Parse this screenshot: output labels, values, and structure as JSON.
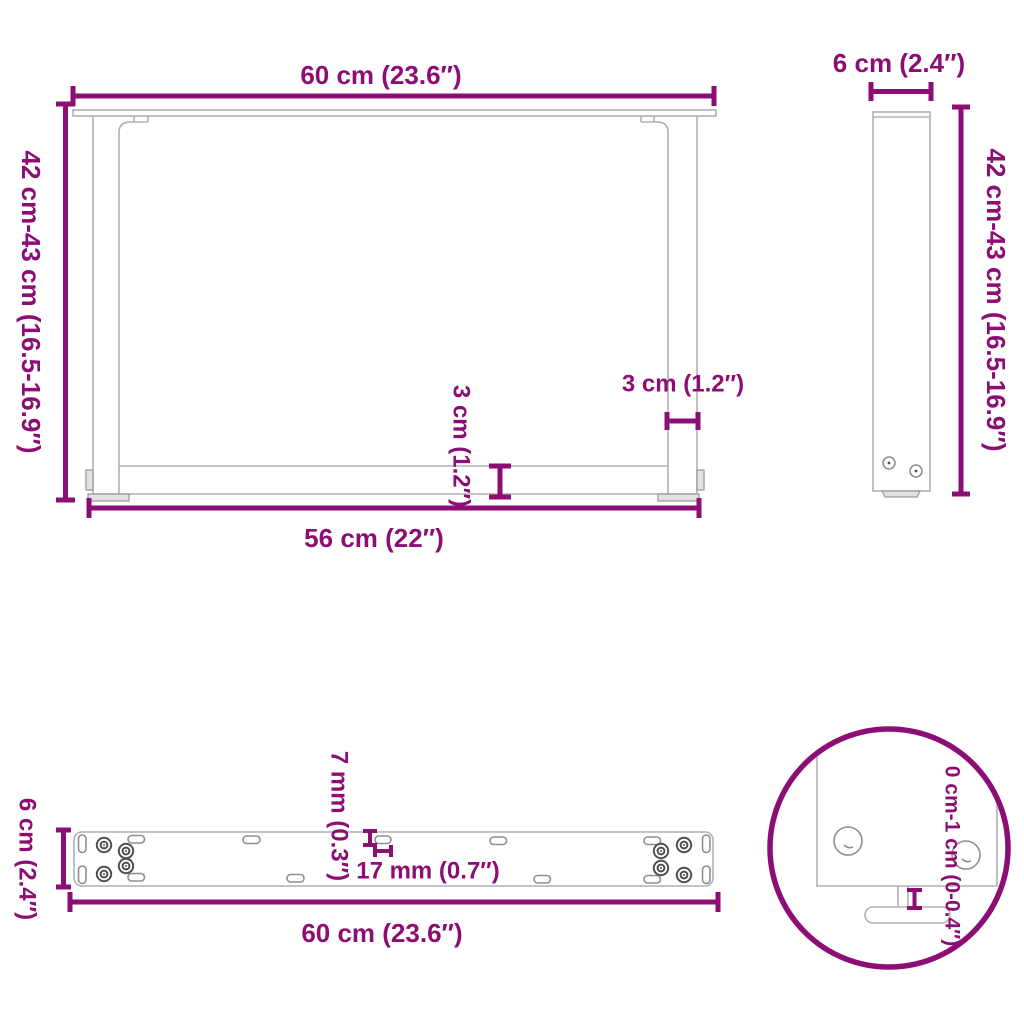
{
  "image_type": "product dimension diagram",
  "subject": "U-shaped table legs with mounting plate and adjustable feet",
  "colors": {
    "dimension": "#8C0E74",
    "structure": "#b0b0b0",
    "structure_fill": "#e2e2e2",
    "background": "#ffffff"
  },
  "views": {
    "front": {
      "name": "front view",
      "labels": {
        "width_top": "60 cm (23.6″)",
        "height": "42 cm-43 cm (16.5-16.9″)",
        "crossbar_thickness": "3 cm (1.2″)",
        "leg_thickness": "3 cm (1.2″)",
        "width_bottom": "56 cm (22″)"
      }
    },
    "side": {
      "name": "side view",
      "labels": {
        "depth": "6 cm (2.4″)",
        "height": "42 cm-43 cm (16.5-16.9″)"
      }
    },
    "plate": {
      "name": "mounting plate top view",
      "labels": {
        "depth": "6 cm (2.4″)",
        "slot_height": "7 mm (0.3″)",
        "slot_width": "17 mm (0.7″)",
        "length": "60 cm (23.6″)"
      }
    },
    "detail": {
      "name": "adjustable foot detail",
      "labels": {
        "adjust_range": "0 cm-1 cm (0-0.4″)"
      }
    }
  }
}
